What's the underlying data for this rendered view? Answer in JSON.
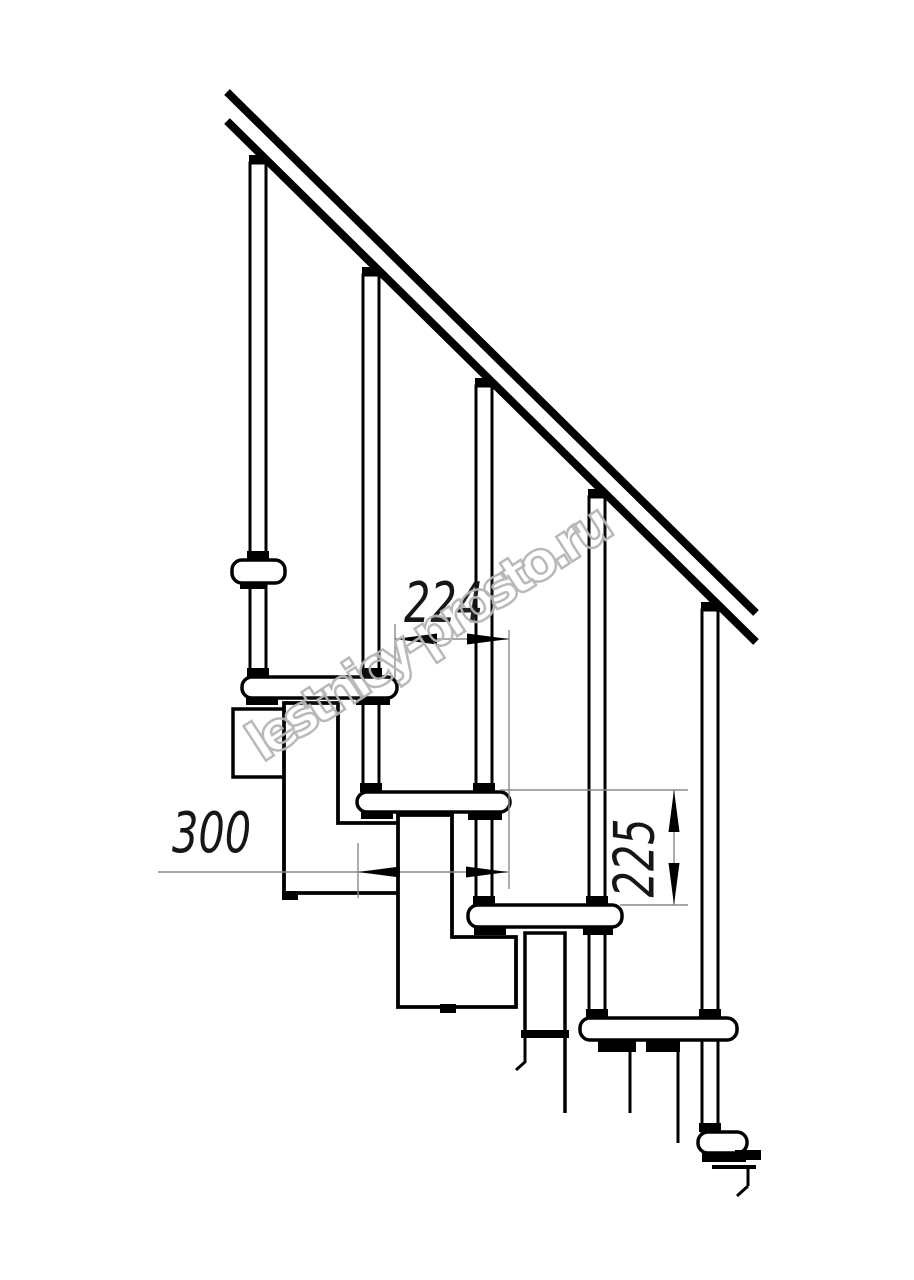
{
  "page": {
    "background": "#ffffff"
  },
  "drawing": {
    "watermark": {
      "text": "lestnicy-prosto.ru",
      "color": "#b6b6b6"
    },
    "line_color": "#000000",
    "dim_line_color": "#8a8a8a",
    "dim_text_color": "#161616",
    "dimensions": {
      "step_run": {
        "value": "224",
        "orientation": "horizontal"
      },
      "tread_depth": {
        "value": "300",
        "orientation": "horizontal"
      },
      "step_rise": {
        "value": "225",
        "orientation": "vertical"
      }
    }
  }
}
